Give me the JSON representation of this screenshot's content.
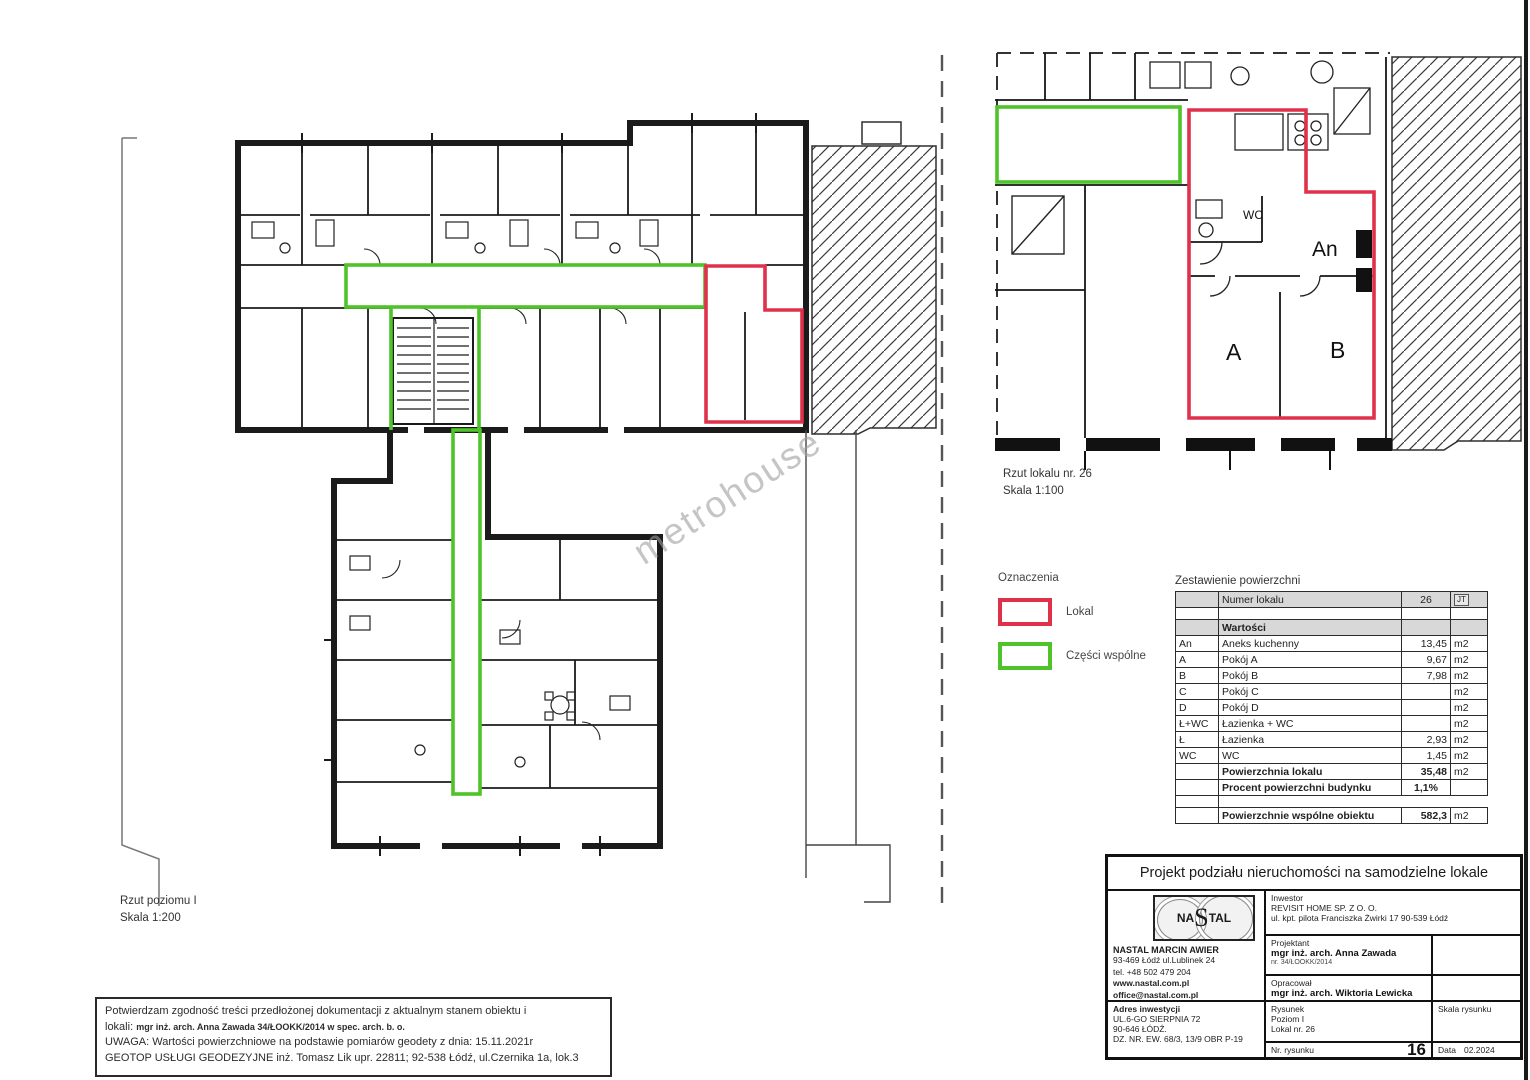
{
  "page": {
    "watermark": "metrohouse"
  },
  "main_plan": {
    "caption1": "Rzut poziomu I",
    "caption2": "Skala 1:200"
  },
  "detail_plan": {
    "caption1": "Rzut lokalu nr. 26",
    "caption2": "Skala 1:100",
    "labels": {
      "wc": "WC",
      "an": "An",
      "a": "A",
      "b": "B"
    }
  },
  "legend": {
    "title": "Oznaczenia",
    "items": [
      {
        "label": "Lokal",
        "color": "#e0314b"
      },
      {
        "label": "Części wspólne",
        "color": "#4ec32a"
      }
    ]
  },
  "area_table": {
    "title": "Zestawienie powierzchni",
    "header": {
      "label": "Numer lokalu",
      "value": "26",
      "unit_badge": "JT"
    },
    "section_label": "Wartości",
    "rows": [
      {
        "code": "An",
        "name": "Aneks kuchenny",
        "value": "13,45",
        "unit": "m2"
      },
      {
        "code": "A",
        "name": "Pokój A",
        "value": "9,67",
        "unit": "m2"
      },
      {
        "code": "B",
        "name": "Pokój B",
        "value": "7,98",
        "unit": "m2"
      },
      {
        "code": "C",
        "name": "Pokój C",
        "value": "",
        "unit": "m2"
      },
      {
        "code": "D",
        "name": "Pokój D",
        "value": "",
        "unit": "m2"
      },
      {
        "code": "Ł+WC",
        "name": "Łazienka + WC",
        "value": "",
        "unit": "m2"
      },
      {
        "code": "Ł",
        "name": "Łazienka",
        "value": "2,93",
        "unit": "m2"
      },
      {
        "code": "WC",
        "name": "WC",
        "value": "1,45",
        "unit": "m2"
      }
    ],
    "summary_rows": [
      {
        "name": "Powierzchnia lokalu",
        "value": "35,48",
        "unit": "m2"
      },
      {
        "name": "Procent powierzchni budynku",
        "value": "1,1%",
        "unit": ""
      }
    ],
    "total_row": {
      "name": "Powierzchnie wspólne obiektu",
      "value": "582,3",
      "unit": "m2"
    }
  },
  "notes": {
    "line1": "Potwierdzam zgodność treści przedłożonej dokumentacji z aktualnym stanem obiektu i",
    "line2_prefix": "lokali: ",
    "line2_bold": "mgr inż. arch. Anna Zawada 34/ŁOOKK/2014 w spec. arch. b. o.",
    "line3": "UWAGA: Wartości powierzchniowe na podstawie pomiarów geodety z dnia: 15.11.2021r",
    "line4": "GEOTOP USŁUGI GEODEZYJNE inż. Tomasz Lik upr. 22811; 92-538 Łódź, ul.Czernika 1a, lok.3"
  },
  "title_block": {
    "title": "Projekt podziału nieruchomości na samodzielne lokale",
    "company": {
      "logo_na": "NA",
      "logo_s": "S",
      "logo_tal": "TAL",
      "name": "NASTAL MARCIN AWIER",
      "address": "93-469 Łódź ul.Lublinek 24",
      "phone": "tel. +48 502 479 204",
      "website": "www.nastal.com.pl",
      "email": "office@nastal.com.pl",
      "project_no": "nr projektu 2018-03-02"
    },
    "invest_address": {
      "label": "Adres inwestycji",
      "line1": "UL.6-GO SIERPNIA 72",
      "line2": "90-646 ŁÓDŹ.",
      "line3": "DZ. NR. EW. 68/3, 13/9 OBR P-19"
    },
    "inwestor": {
      "label": "Inwestor",
      "name": "REVISIT HOME SP. Z O. O.",
      "address": "ul. kpt. pilota Franciszka Żwirki 17  90-539 Łódź"
    },
    "projektant": {
      "label": "Projektant",
      "name": "mgr inż. arch. Anna Zawada",
      "number": "nr. 34/ŁOOKK/2014"
    },
    "opracowal": {
      "label": "Opracował",
      "name": "mgr inż. arch. Wiktoria Lewicka"
    },
    "rysunek": {
      "label": "Rysunek",
      "line1": "Poziom I",
      "line2": "Lokal nr. 26",
      "scale_label": "Skala rysunku"
    },
    "footer": {
      "number_label": "Nr. rysunku",
      "number": "16",
      "date_label": "Data",
      "date": "02.2024"
    }
  }
}
